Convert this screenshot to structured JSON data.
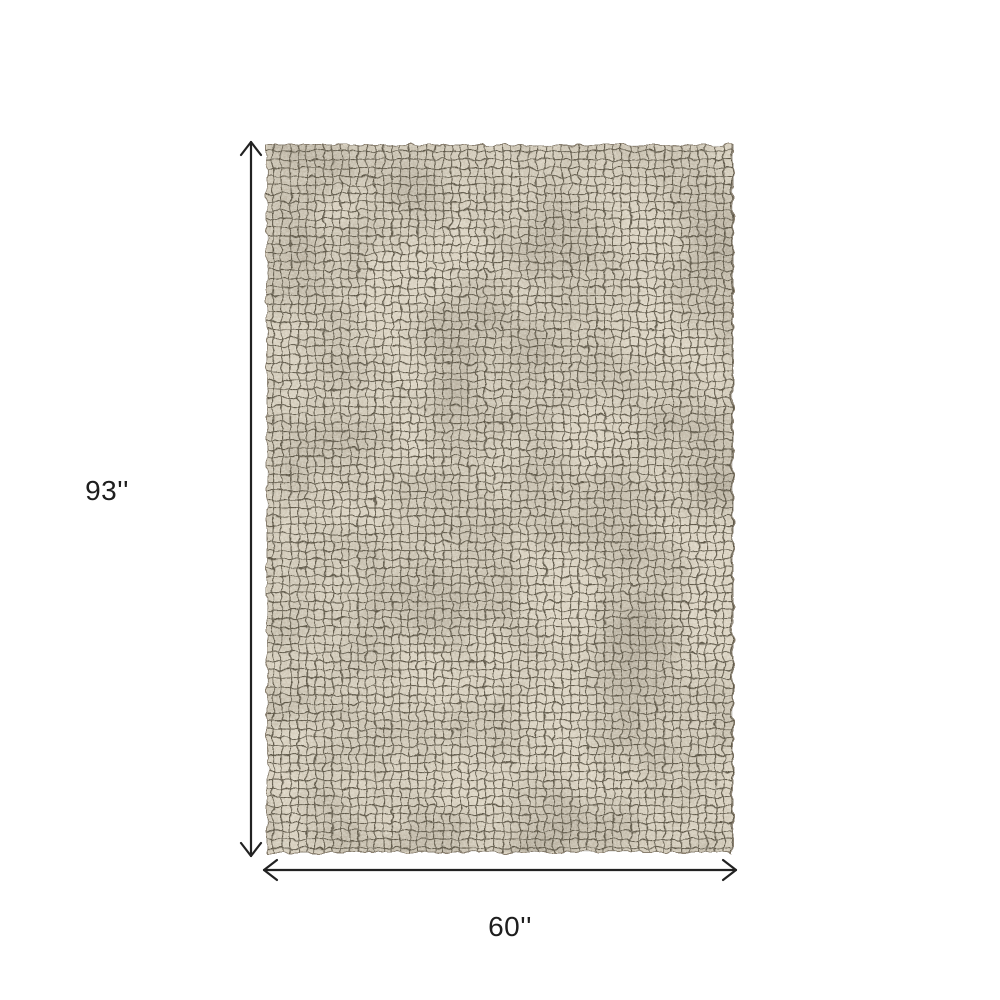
{
  "diagram": {
    "type": "product-dimension-diagram",
    "subject": "grid-pattern-area-rug",
    "height_label": "93''",
    "width_label": "60''",
    "colors": {
      "page_background": "#ffffff",
      "rug_base": "#d9d1c0",
      "rug_grid_line": "#5e5747",
      "dimension_line": "#222222",
      "label_text": "#1e1e1e"
    },
    "icons": {
      "vertical_arrow": "double-headed-arrow-vertical-icon",
      "horizontal_arrow": "double-headed-arrow-horizontal-icon"
    }
  }
}
